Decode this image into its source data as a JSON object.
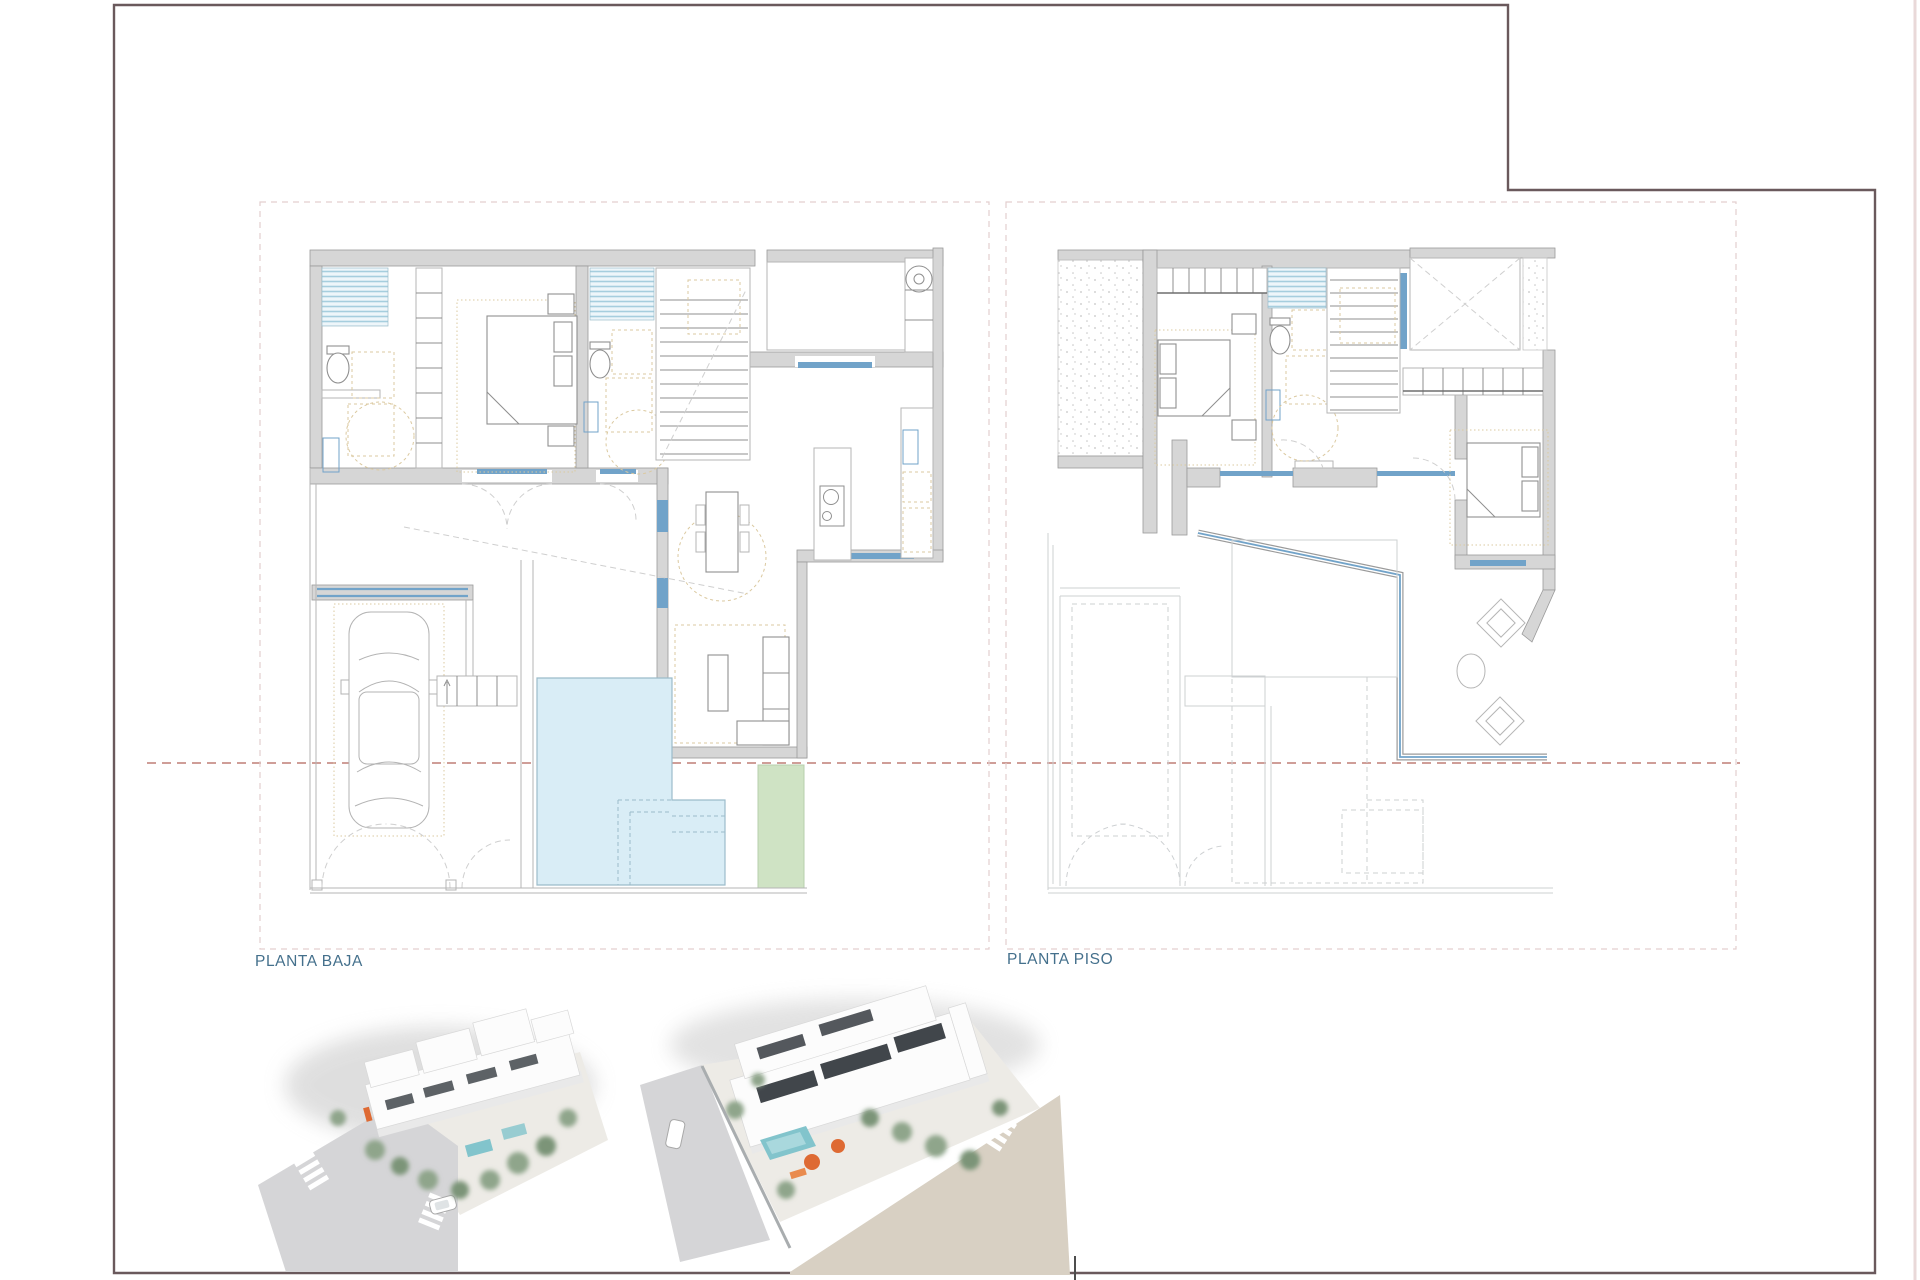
{
  "plans": [
    {
      "name": "ground-floor-plan",
      "label": "PLANTA BAJA",
      "features": [
        "garage-with-car",
        "entry-porch",
        "swimming-pool",
        "lawn-strip",
        "bedroom-suite",
        "two-bathrooms",
        "staircase",
        "laundry-room",
        "kitchen-island",
        "dining-table",
        "sofa-corner",
        "patio"
      ]
    },
    {
      "name": "upper-floor-plan",
      "label": "PLANTA PISO",
      "features": [
        "solarium-terrace",
        "bedroom-2",
        "bedroom-3",
        "bathroom",
        "staircase",
        "void-over-living",
        "terrace-lounge",
        "ghost-outline-of-ground-floor"
      ]
    }
  ],
  "renders": [
    {
      "name": "exterior-aerial-render-street-corner"
    },
    {
      "name": "exterior-aerial-render-rear-terrace"
    }
  ],
  "palette": {
    "frame_border": "#6a595c",
    "label_text": "#44708c",
    "wall_fill": "#d6d6d6",
    "wall_stroke": "#9a9a9a",
    "line_thin": "#b5b5b5",
    "ghost_line": "#cdd0d2",
    "window_blue": "#71a3c9",
    "shower_stripe_blue": "#a6cede",
    "pool_fill": "#d9edf6",
    "pool_stroke": "#9cbcca",
    "lawn_green": "#cfe3c4",
    "furniture_beige": "#dbc9a0",
    "section_line_red": "#b4695f",
    "boundary_dash_pink": "#e3cfcf",
    "render_road_gray": "#d5d5d7",
    "render_road_tan": "#d8d0c3",
    "render_tree_green": "#8fa58b",
    "render_pool_aqua": "#82c4cc",
    "render_accent_orange": "#de6a33",
    "render_window_dark": "#41464b",
    "render_shadow": "#bfbfbf"
  }
}
